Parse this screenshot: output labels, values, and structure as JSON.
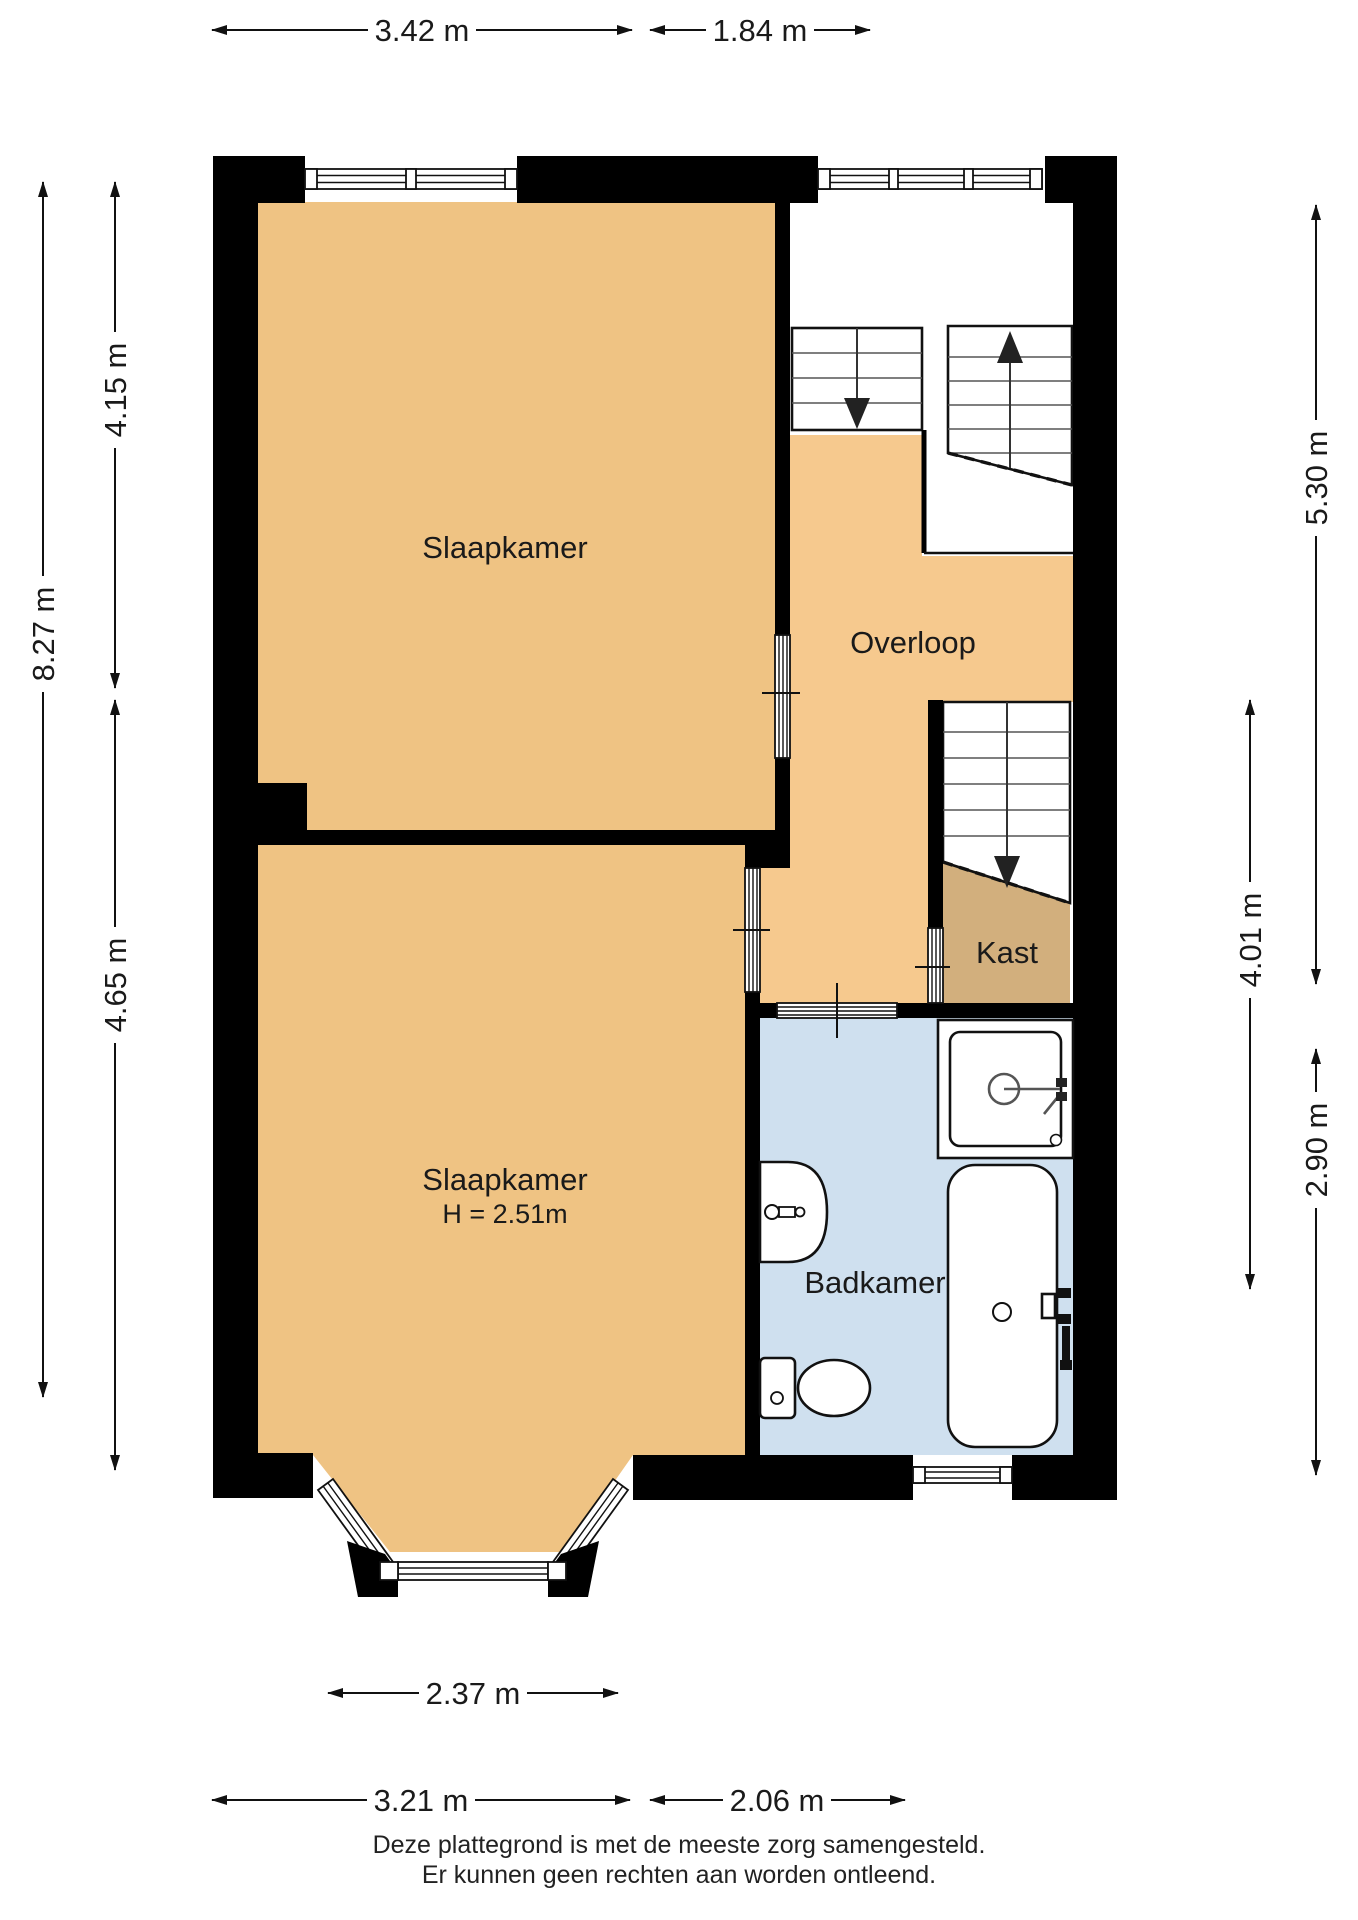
{
  "rooms": {
    "slaapkamer1": {
      "label": "Slaapkamer"
    },
    "slaapkamer2": {
      "label": "Slaapkamer",
      "height_note": "H = 2.51m"
    },
    "overloop": {
      "label": "Overloop"
    },
    "kast": {
      "label": "Kast"
    },
    "badkamer": {
      "label": "Badkamer"
    }
  },
  "dimensions": {
    "top": [
      {
        "label": "3.42 m"
      },
      {
        "label": "1.84 m"
      }
    ],
    "left": [
      {
        "label": "8.27 m"
      },
      {
        "label": "4.15 m"
      },
      {
        "label": "4.65 m"
      }
    ],
    "right": [
      {
        "label": "5.30 m"
      },
      {
        "label": "4.01 m"
      },
      {
        "label": "2.90 m"
      }
    ],
    "bottom": [
      {
        "label": "2.37 m"
      },
      {
        "label": "3.21 m"
      },
      {
        "label": "2.06 m"
      }
    ]
  },
  "footer": {
    "line1": "Deze plattegrond is met de meeste zorg samengesteld.",
    "line2": "Er kunnen geen rechten aan worden ontleend."
  },
  "colors": {
    "bedroom": "#EFC383",
    "hall": "#F6C98E",
    "closet": "#D2AF7D",
    "bathroom": "#CFE0EF",
    "wall": "#000000"
  }
}
